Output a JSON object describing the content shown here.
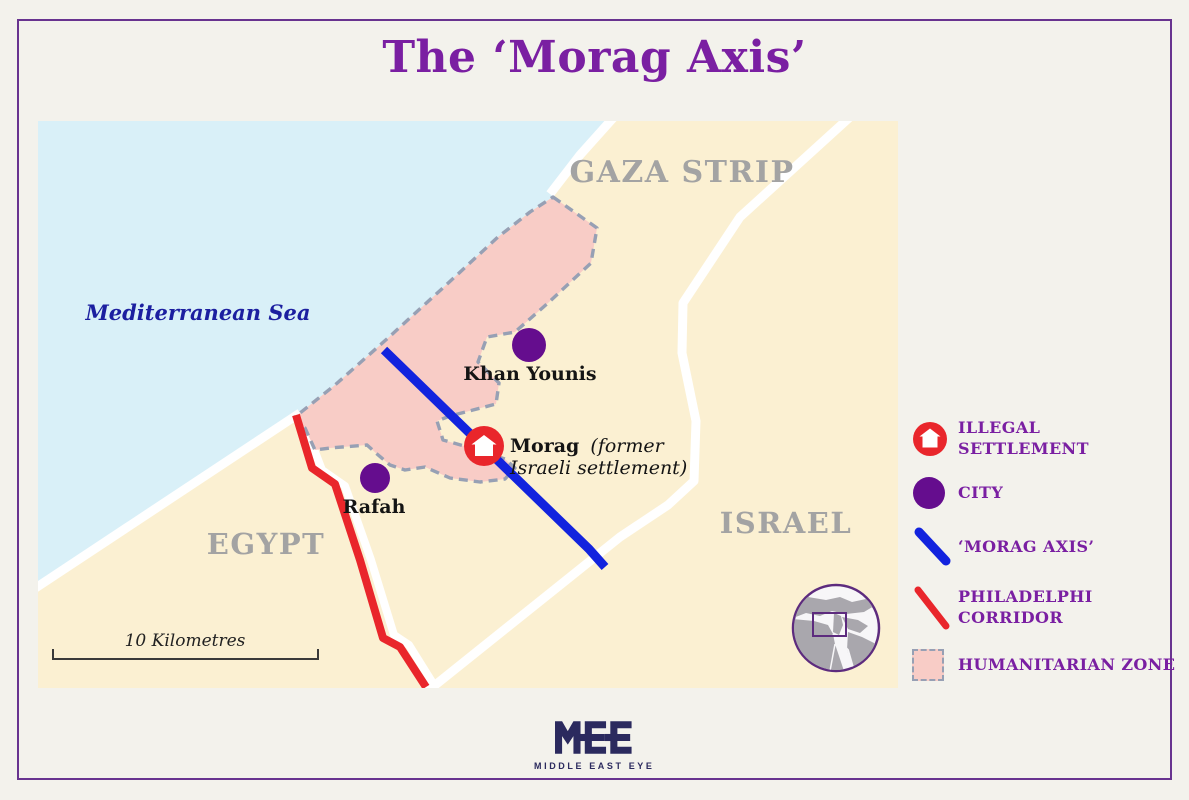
{
  "title": "The ‘Morag Axis’",
  "map": {
    "region_labels": {
      "sea": "Mediterranean Sea",
      "gaza": "GAZA STRIP",
      "egypt": "EGYPT",
      "israel": "ISRAEL"
    },
    "cities": {
      "khan_younis": "Khan Younis",
      "rafah": "Rafah"
    },
    "morag": {
      "bold": "Morag",
      "italic1": "(former",
      "italic2": "Israeli settlement)"
    },
    "scale_label": "10 Kilometres"
  },
  "legend": {
    "items": [
      {
        "id": "illegal-settlement",
        "lines": [
          "ILLEGAL",
          "SETTLEMENT"
        ]
      },
      {
        "id": "city",
        "lines": [
          "CITY"
        ]
      },
      {
        "id": "morag-axis",
        "lines": [
          "‘MORAG AXIS’"
        ]
      },
      {
        "id": "philadelphi-corridor",
        "lines": [
          "PHILADELPHI",
          "CORRIDOR"
        ]
      },
      {
        "id": "humanitarian-zone",
        "lines": [
          "HUMANITARIAN ZONE"
        ]
      }
    ]
  },
  "footer": {
    "logo_text": "MEE",
    "logo_subtext": "MIDDLE EAST EYE"
  },
  "colors": {
    "accent_purple": "#7a1fa2",
    "card_border": "#68338f",
    "land": "#fbf0d2",
    "sea": "#d9f0f8",
    "humanitarian_zone": "#f8ccc6",
    "zone_border": "#97a0b4",
    "morag_axis_blue": "#1223de",
    "philadelphi_red": "#e9262b",
    "city_purple": "#650d8e",
    "country_label_gray": "#a3a3a3",
    "sea_label_blue": "#1c1fa0",
    "logo_navy": "#2b2a5e"
  }
}
